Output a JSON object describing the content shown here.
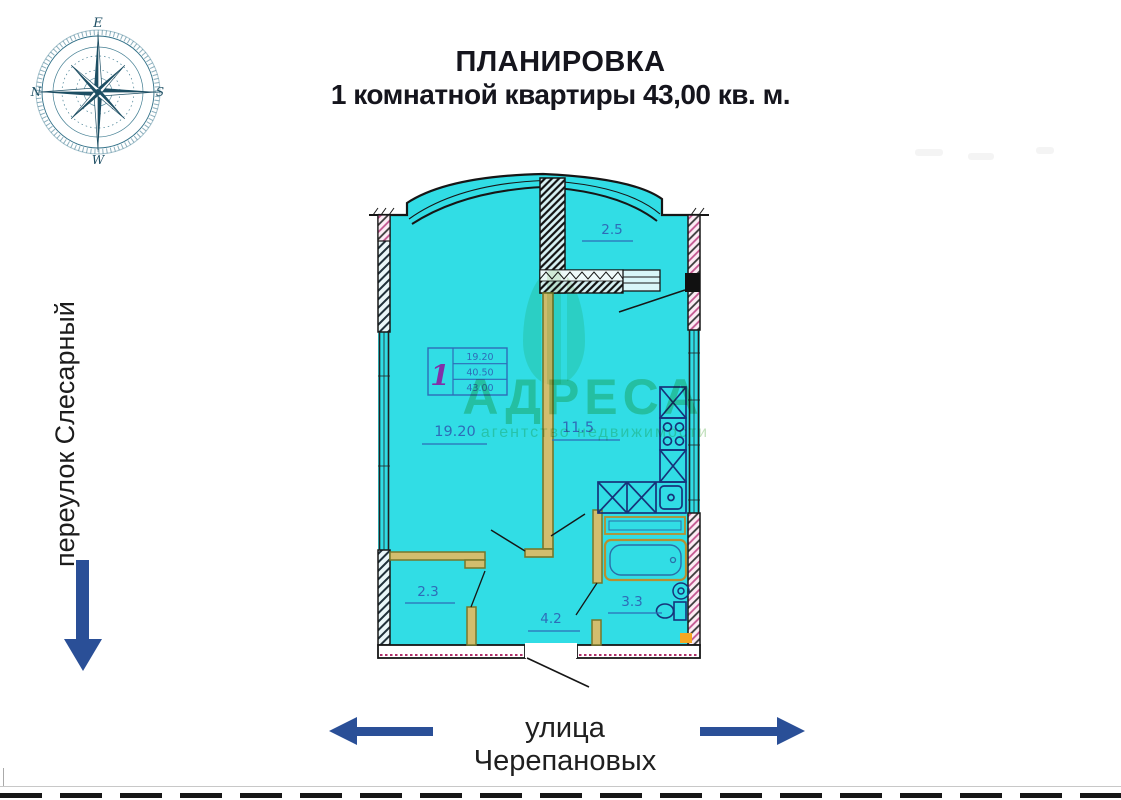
{
  "header": {
    "title_line1": "ПЛАНИРОВКА",
    "title_line2": "1 комнатной квартиры 43,00 кв. м."
  },
  "compass": {
    "top": "E",
    "right": "S",
    "bottom": "W",
    "left": "N"
  },
  "streets": {
    "left_vertical": "переулок Слесарный",
    "bottom": "улица Черепановых"
  },
  "floor_plan": {
    "rooms": [
      {
        "name": "loggia",
        "area": "2.5"
      },
      {
        "name": "living-room",
        "area": "19.20"
      },
      {
        "name": "kitchen",
        "area": "11.5"
      },
      {
        "name": "wardrobe",
        "area": "2.3"
      },
      {
        "name": "hallway",
        "area": "4.2"
      },
      {
        "name": "bathroom",
        "area": "3.3"
      }
    ],
    "stamp": {
      "apartment_number": "1",
      "living_area": "19.20",
      "apartment_area": "40.50",
      "total_area": "43.00"
    }
  },
  "watermark": {
    "brand": "АДРЕСА",
    "subtitle": "агентство недвижимости"
  },
  "colors": {
    "plan_fill": "#31dde5",
    "accent_navy": "#2a4f97",
    "label_blue": "#2e6cb8",
    "wall_dark": "#161616",
    "partition_fill": "#d2bd6e",
    "partition_olive": "#77772a",
    "hatch_pink": "#c2558f",
    "magenta_dotted": "#b0306a",
    "fixture_navy": "#16337a",
    "tub_tan": "#b98f2e",
    "watermark_green": "#8fcb8f",
    "stamp_purple": "#8130a8",
    "compass_teal": "#1d4e63",
    "orange_marker": "#f5a623"
  }
}
